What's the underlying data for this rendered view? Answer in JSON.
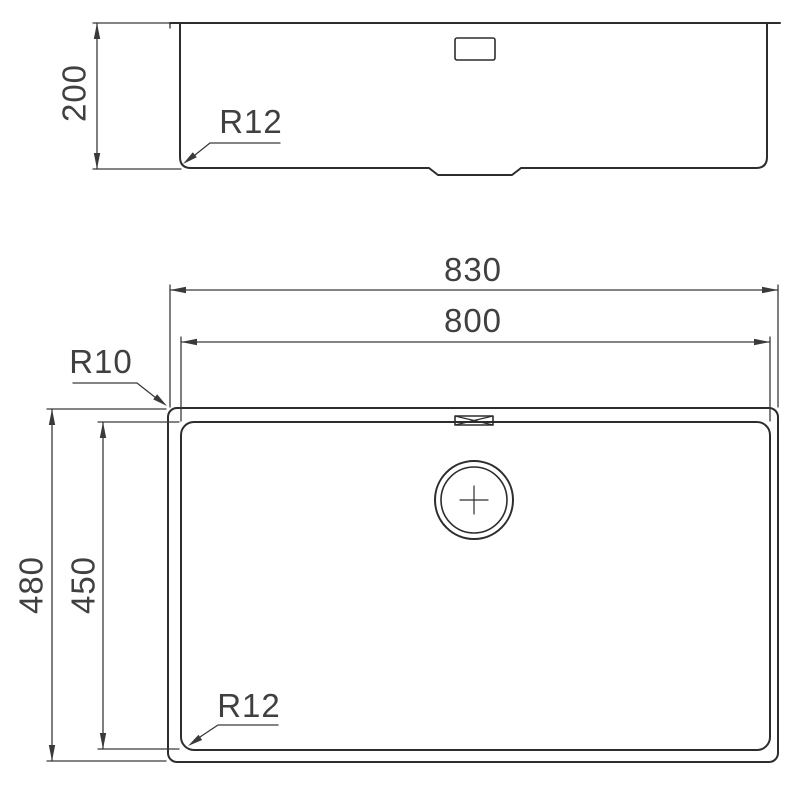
{
  "drawing": {
    "type": "technical-drawing",
    "subject": "undermount-sink-dimension-drawing",
    "colors": {
      "background": "#ffffff",
      "line": "#2d2d2d",
      "dim_line": "#3a3a3a",
      "text": "#404040"
    },
    "side_view": {
      "height_dim": {
        "label": "200",
        "orientation": "vertical"
      },
      "bottom_corner_radius": {
        "label": "R12"
      }
    },
    "plan_view": {
      "outer_width_dim": {
        "label": "830",
        "orientation": "horizontal"
      },
      "inner_width_dim": {
        "label": "800",
        "orientation": "horizontal"
      },
      "outer_depth_dim": {
        "label": "480",
        "orientation": "vertical"
      },
      "inner_depth_dim": {
        "label": "450",
        "orientation": "vertical"
      },
      "outer_corner_radius": {
        "label": "R10"
      },
      "inner_corner_radius": {
        "label": "R12"
      }
    }
  }
}
